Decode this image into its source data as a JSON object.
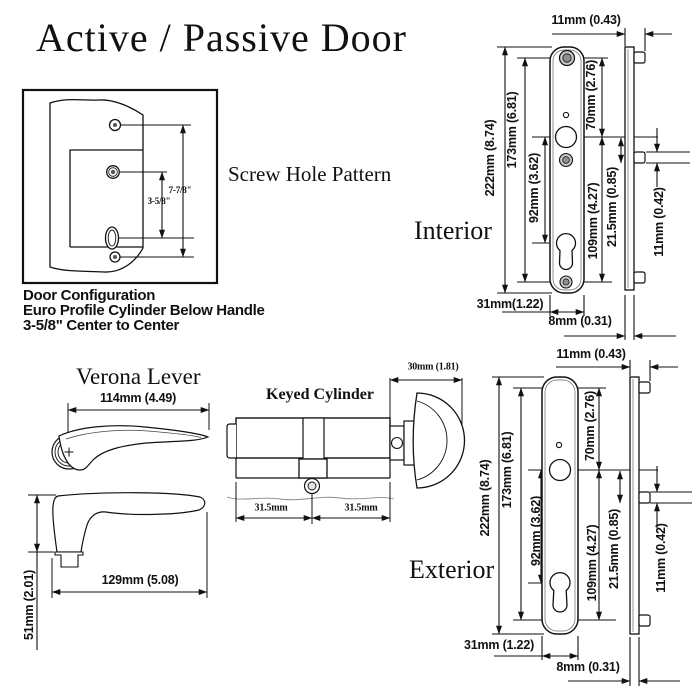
{
  "title": "Active / Passive Door",
  "screw_box": {
    "heading": "Screw Hole Pattern",
    "dim_long": "7-7/8\"",
    "dim_short": "3-5/8\"",
    "caption": [
      "Door Configuration",
      "Euro Profile Cylinder Below Handle",
      "3-5/8\" Center to Center"
    ]
  },
  "interior": {
    "label": "Interior",
    "dim_top_width": "11mm (0.43)",
    "dim_overall": "222mm (8.74)",
    "dim_screws": "173mm (6.81)",
    "dim_handle_cyl": "92mm (3.62)",
    "dim_top_handle": "70mm (2.76)",
    "dim_handle_bottom": "109mm (4.27)",
    "dim_pin_offset": "21.5mm (0.85)",
    "dim_pin": "11mm (0.42)",
    "dim_width": "31mm(1.22)",
    "dim_depth": "8mm (0.31)"
  },
  "exterior": {
    "label": "Exterior",
    "dim_top_width": "11mm (0.43)",
    "dim_overall": "222mm (8.74)",
    "dim_screws": "173mm (6.81)",
    "dim_handle_cyl": "92mm (3.62)",
    "dim_top_handle": "70mm (2.76)",
    "dim_handle_bottom": "109mm (4.27)",
    "dim_pin_offset": "21.5mm (0.85)",
    "dim_pin": "11mm (0.42)",
    "dim_width": "31mm (1.22)",
    "dim_depth": "8mm (0.31)"
  },
  "lever": {
    "label": "Verona Lever",
    "dim_length_top": "114mm (4.49)",
    "dim_length_side": "129mm (5.08)",
    "dim_height": "51mm (2.01)"
  },
  "cylinder": {
    "label": "Keyed Cylinder",
    "dim_thumbturn": "30mm (1.81)",
    "dim_left": "31.5mm",
    "dim_right": "31.5mm"
  }
}
